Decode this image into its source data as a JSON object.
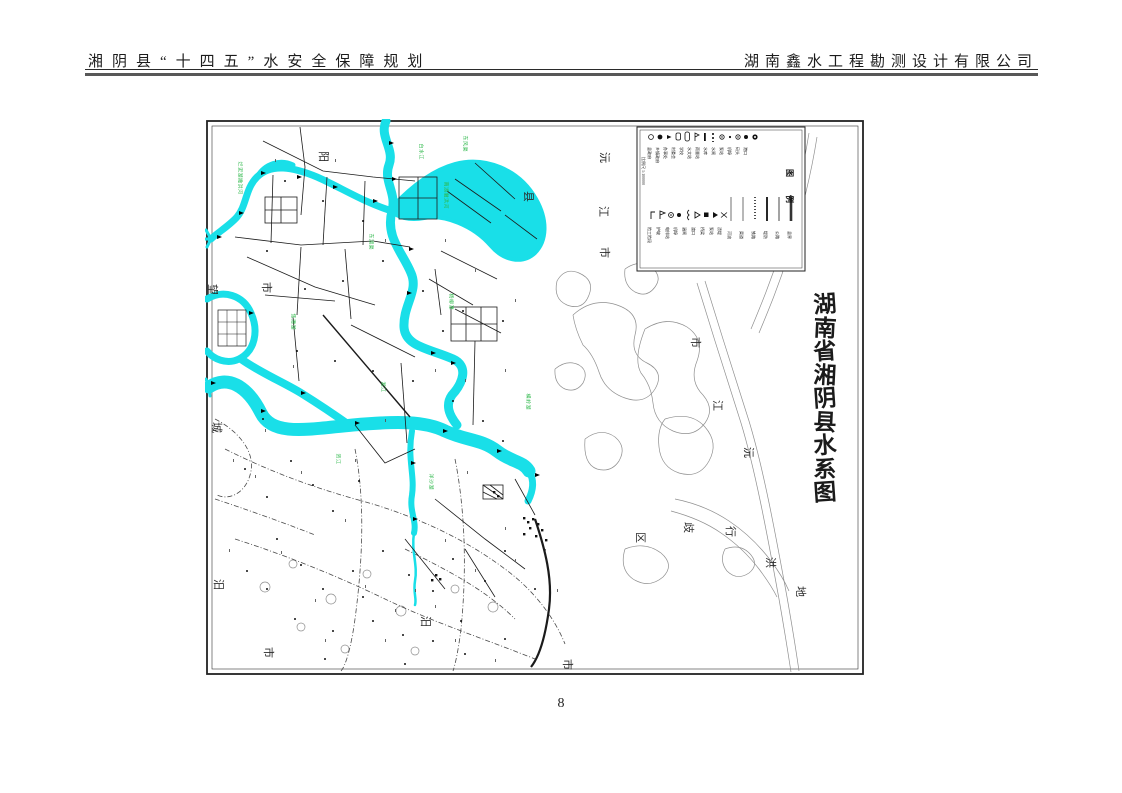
{
  "header": {
    "left_title": "湘阴县“十四五”水安全保障规划",
    "right_title": "湖南鑫水工程勘测设计有限公司"
  },
  "page": {
    "number": "8"
  },
  "map": {
    "title": "湖南省湘阴县水系图",
    "colors": {
      "water": "#19dfe8",
      "river_label_green": "#2eb84b",
      "line": "#1b1b1b",
      "contour": "#8f8f8f"
    },
    "legend": {
      "title": "图例",
      "scale_note": "比例尺 1:100000",
      "point_items": [
        {
          "symbol": "circle-outline-icon",
          "label": "县政府"
        },
        {
          "symbol": "circle-filled-icon",
          "label": "乡镇政府"
        },
        {
          "symbol": "triangle-left-icon",
          "label": "办事处"
        },
        {
          "symbol": "rounded-rect-icon",
          "label": "村委会"
        },
        {
          "symbol": "rounded-rect-tall-icon",
          "label": "学校"
        },
        {
          "symbol": "flag-icon",
          "label": "水文站"
        },
        {
          "symbol": "bar-solid-icon",
          "label": "雨量站"
        },
        {
          "symbol": "bar-dashed-icon",
          "label": "水库"
        },
        {
          "symbol": "circle-dot-icon",
          "label": "水闸"
        },
        {
          "symbol": "dot-icon",
          "label": "泵站"
        },
        {
          "symbol": "circle-dot-icon",
          "label": "机埠"
        },
        {
          "symbol": "circle-filled-icon",
          "label": "码头"
        },
        {
          "symbol": "bullseye-icon",
          "label": "港口"
        }
      ],
      "flag_items": [
        {
          "symbol": "corner-flag-icon",
          "label": "险工险段"
        },
        {
          "symbol": "pennant-icon",
          "label": "护坡"
        },
        {
          "symbol": "bullseye-icon",
          "label": "电排站"
        },
        {
          "symbol": "circle-filled-icon",
          "label": "机埠"
        },
        {
          "symbol": "brace-icon",
          "label": "涵闸"
        },
        {
          "symbol": "triangle-outline-icon",
          "label": "渡口"
        },
        {
          "symbol": "square-filled-icon",
          "label": "桥梁"
        },
        {
          "symbol": "triangle-filled-icon",
          "label": "泵站"
        },
        {
          "symbol": "bowtie-icon",
          "label": "渍堤"
        }
      ],
      "line_items": [
        {
          "style": "thin",
          "label": "河流"
        },
        {
          "style": "thin",
          "label": "渠道"
        },
        {
          "style": "dotted",
          "label": "铁路"
        },
        {
          "style": "medium",
          "label": "堤防"
        },
        {
          "style": "gray",
          "label": "公路"
        },
        {
          "style": "thick",
          "label": "县界"
        }
      ]
    },
    "boundary_labels": [
      {
        "text": "阳",
        "x": 112,
        "y": 32
      },
      {
        "text": "市",
        "x": 55,
        "y": 163
      },
      {
        "text": "望",
        "x": 1,
        "y": 165
      },
      {
        "text": "城",
        "x": 5,
        "y": 303
      },
      {
        "text": "汨",
        "x": 7,
        "y": 460
      },
      {
        "text": "市",
        "x": 57,
        "y": 528
      },
      {
        "text": "县",
        "x": 317,
        "y": 72
      },
      {
        "text": "沅",
        "x": 393,
        "y": 33
      },
      {
        "text": "江",
        "x": 392,
        "y": 87
      },
      {
        "text": "市",
        "x": 393,
        "y": 128
      },
      {
        "text": "市",
        "x": 484,
        "y": 218
      },
      {
        "text": "江",
        "x": 506,
        "y": 281
      },
      {
        "text": "沅",
        "x": 537,
        "y": 328
      },
      {
        "text": "区",
        "x": 429,
        "y": 413
      },
      {
        "text": "歧",
        "x": 477,
        "y": 403
      },
      {
        "text": "行",
        "x": 519,
        "y": 407
      },
      {
        "text": "洪",
        "x": 559,
        "y": 438
      },
      {
        "text": "地",
        "x": 589,
        "y": 467
      },
      {
        "text": "汨",
        "x": 214,
        "y": 497
      },
      {
        "text": "市",
        "x": 356,
        "y": 540
      }
    ],
    "river_labels": [
      {
        "text": "烂泥湖撇洪河",
        "x": 34,
        "y": 40
      },
      {
        "text": "白水江",
        "x": 215,
        "y": 22
      },
      {
        "text": "东风渠",
        "x": 259,
        "y": 14
      },
      {
        "text": "南湖撇洪河",
        "x": 240,
        "y": 60
      },
      {
        "text": "东湖渠",
        "x": 165,
        "y": 112
      },
      {
        "text": "焦潭湖",
        "x": 87,
        "y": 192
      },
      {
        "text": "湘江",
        "x": 177,
        "y": 260
      },
      {
        "text": "杨柳潭",
        "x": 245,
        "y": 172
      },
      {
        "text": "洋沙湖",
        "x": 225,
        "y": 352
      },
      {
        "text": "资江",
        "x": 132,
        "y": 332
      },
      {
        "text": "横岭湖",
        "x": 322,
        "y": 272
      }
    ]
  }
}
